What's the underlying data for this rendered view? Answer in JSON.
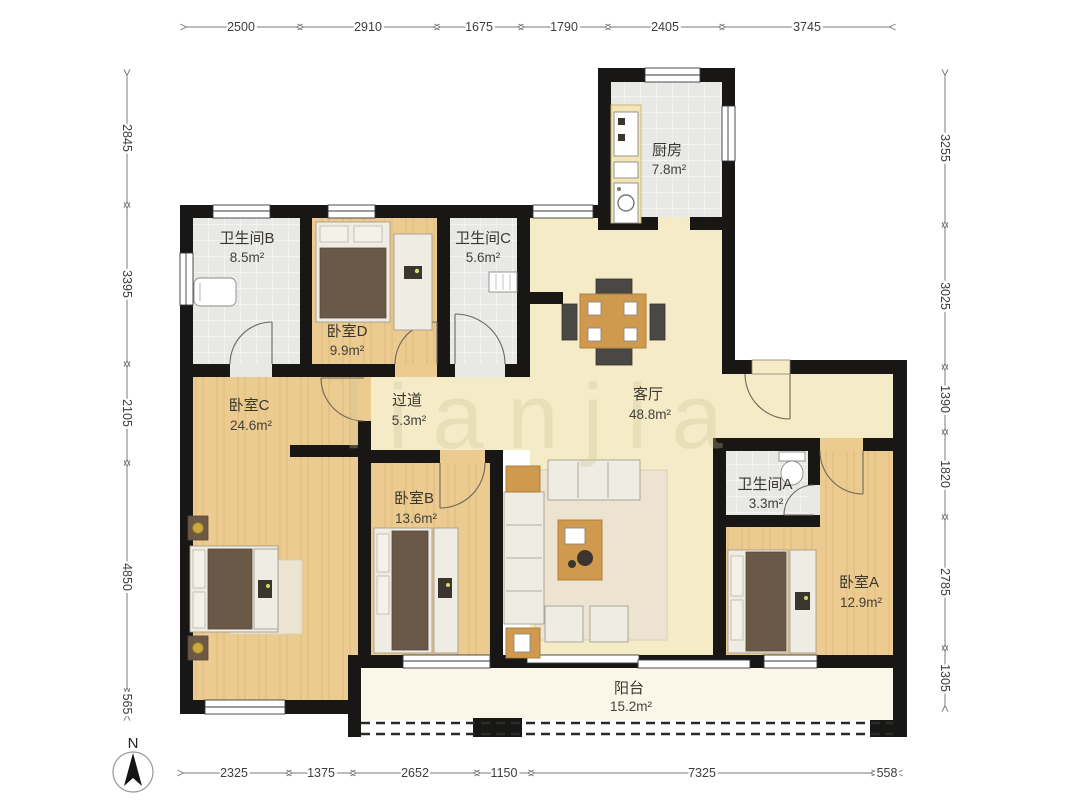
{
  "watermark": {
    "text": "lianjia"
  },
  "compass": {
    "north_label": "N"
  },
  "rooms": [
    {
      "id": "bathroom-b",
      "name": "卫生间B",
      "area": "8.5m²"
    },
    {
      "id": "bedroom-d",
      "name": "卧室D",
      "area": "9.9m²"
    },
    {
      "id": "bathroom-c",
      "name": "卫生间C",
      "area": "5.6m²"
    },
    {
      "id": "kitchen",
      "name": "厨房",
      "area": "7.8m²"
    },
    {
      "id": "living-room",
      "name": "客厅",
      "area": "48.8m²"
    },
    {
      "id": "hallway",
      "name": "过道",
      "area": "5.3m²"
    },
    {
      "id": "bedroom-c",
      "name": "卧室C",
      "area": "24.6m²"
    },
    {
      "id": "bedroom-b",
      "name": "卧室B",
      "area": "13.6m²"
    },
    {
      "id": "bathroom-a",
      "name": "卫生间A",
      "area": "3.3m²"
    },
    {
      "id": "bedroom-a",
      "name": "卧室A",
      "area": "12.9m²"
    },
    {
      "id": "balcony",
      "name": "阳台",
      "area": "15.2m²"
    }
  ],
  "dimensions": {
    "top": [
      "2500",
      "2910",
      "1675",
      "1790",
      "2405",
      "3745"
    ],
    "left": [
      "2845",
      "3395",
      "2105",
      "4850",
      "565"
    ],
    "right": [
      "3255",
      "3025",
      "1390",
      "1820",
      "2785",
      "1305"
    ],
    "bottom": [
      "2325",
      "1375",
      "2652",
      "1150",
      "7325",
      "558"
    ]
  },
  "colors": {
    "wall": "#181715",
    "wood_floor": "#eccb90",
    "tile_floor": "#e8e8e6",
    "living_floor": "#f5ecc7",
    "balcony_floor": "#fbf7e8",
    "dimension_text": "#3c3c3c"
  }
}
